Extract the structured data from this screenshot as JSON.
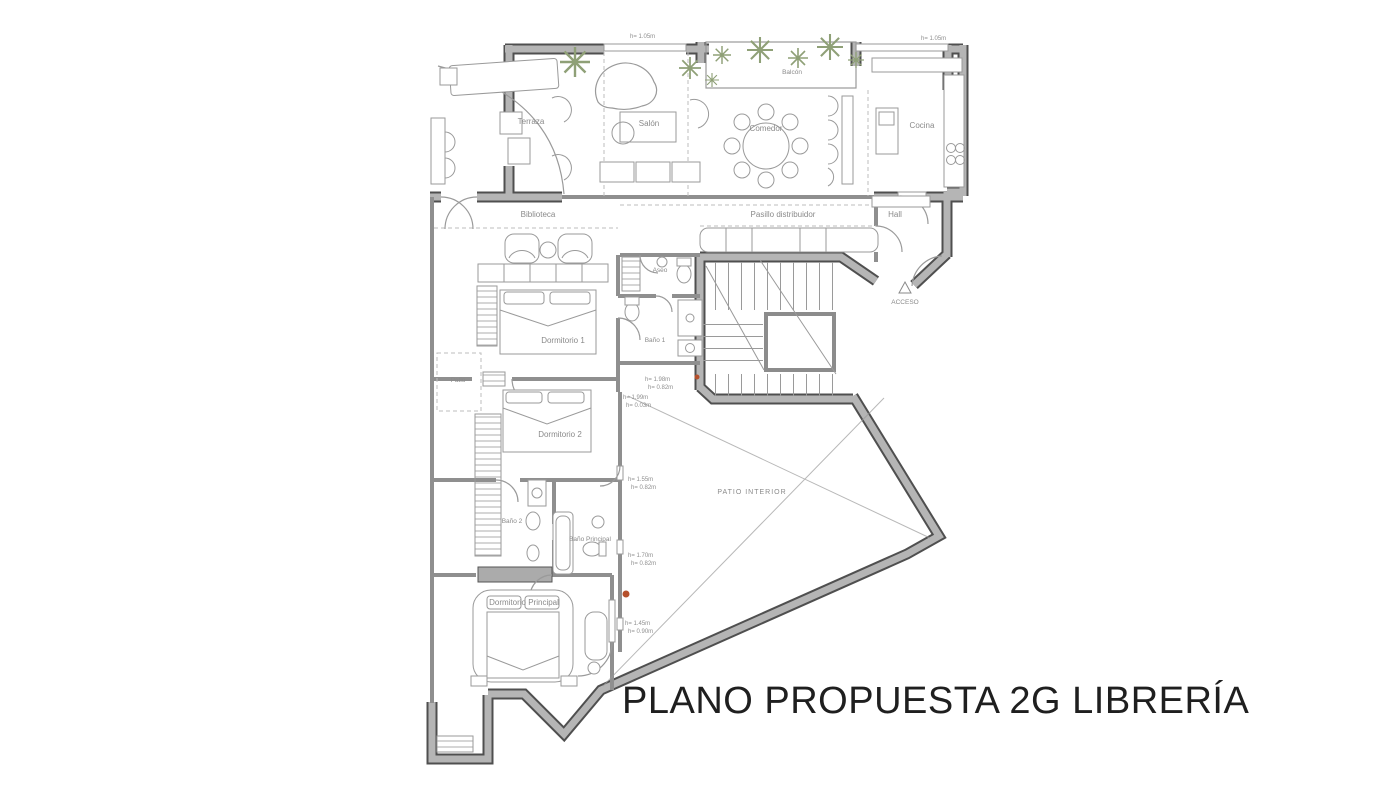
{
  "title": "PLANO PROPUESTA 2G LIBRERÍA",
  "rooms": {
    "terraza": "Terraza",
    "salon": "Salón",
    "balcon": "Balcón",
    "comedor": "Comedor",
    "cocina": "Cocina",
    "biblioteca": "Biblioteca",
    "pasillo": "Pasillo distribuidor",
    "hall": "Hall",
    "aseo": "Aseo",
    "bano1": "Baño 1",
    "dormitorio1": "Dormitorio 1",
    "patio": "Patio",
    "dormitorio2": "Dormitorio 2",
    "bano2": "Baño 2",
    "bano_principal": "Baño Principal",
    "dormitorio_principal": "Dormitorio Principal",
    "patio_interior": "PATIO INTERIOR",
    "acceso": "ACCESO"
  },
  "annotations": {
    "window_left": "h= 1.05m",
    "window_right": "h= 1.05m",
    "dims": [
      {
        "l1": "h= 1.98m",
        "l2": "h= 0.82m"
      },
      {
        "l1": "h= 1.99m",
        "l2": "h= 0.03m"
      },
      {
        "l1": "h= 1.55m",
        "l2": "h= 0.82m"
      },
      {
        "l1": "h= 1.70m",
        "l2": "h= 0.82m"
      },
      {
        "l1": "h= 1.45m",
        "l2": "h= 0.90m"
      }
    ]
  },
  "colors": {
    "wall_edge": "#4f4f4f",
    "wall_fill": "#b5b5b5",
    "drawing_line": "#9a9a9a",
    "plant": "#8fa077",
    "marker": "#b5502c",
    "title": "#1f1f1f"
  }
}
